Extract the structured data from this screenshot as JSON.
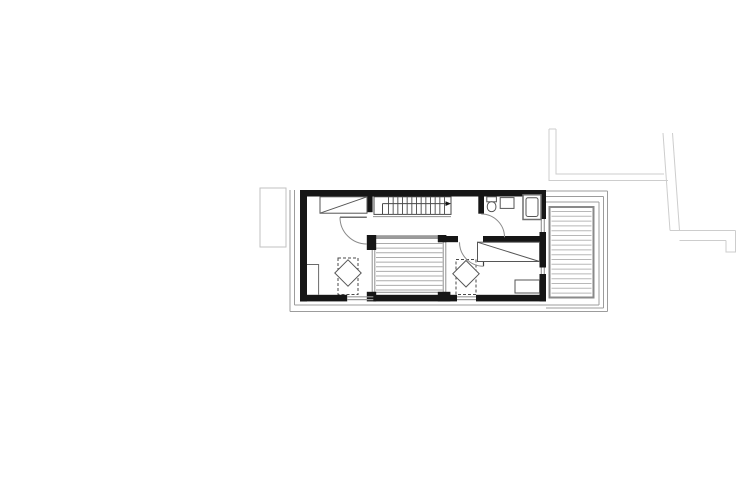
{
  "canvas": {
    "width": 737,
    "height": 492,
    "background": "#ffffff"
  },
  "palette": {
    "wall": "#161616",
    "fixture_line": "#565656",
    "stair_line": "#4a4a4a",
    "swing_arc": "#8a8a8a",
    "void_edge": "#8f8f8f",
    "deck_border": "#8a8a8a",
    "deck_hatch": "#b8b8b8",
    "void_hatch": "#ababab",
    "roof_outline": "#9c9c9c",
    "glazing": "#9a9a9a",
    "site_line": "#cdcdcd",
    "annex_line": "#c2c2c2",
    "beam": "#9b9b9b"
  },
  "drawing": {
    "elements": [
      {
        "type": "line",
        "name": "site-line-north-cap",
        "x1": 549,
        "y1": 129,
        "x2": 556,
        "y2": 129,
        "stroke": "#cdcdcd",
        "sw": 1
      },
      {
        "type": "polyline",
        "name": "site-line-west-outer",
        "points": "549,129 549,180.5 668,180.5",
        "stroke": "#cdcdcd",
        "sw": 1
      },
      {
        "type": "polyline",
        "name": "site-line-west-inner",
        "points": "556,129 556,174 664,174",
        "stroke": "#cdcdcd",
        "sw": 1
      },
      {
        "type": "line",
        "name": "site-line-east-outer-vertical",
        "x1": 663,
        "y1": 133,
        "x2": 670,
        "y2": 230.5,
        "stroke": "#cdcdcd",
        "sw": 1
      },
      {
        "type": "line",
        "name": "site-line-east-inner-vertical",
        "x1": 672.5,
        "y1": 133,
        "x2": 679.5,
        "y2": 230.5,
        "stroke": "#cdcdcd",
        "sw": 1
      },
      {
        "type": "line",
        "name": "site-line-east-top",
        "x1": 670,
        "y1": 230.5,
        "x2": 735.5,
        "y2": 230.5,
        "stroke": "#cdcdcd",
        "sw": 1
      },
      {
        "type": "line",
        "name": "site-line-east-bottom",
        "x1": 679.5,
        "y1": 240.5,
        "x2": 726,
        "y2": 240.5,
        "stroke": "#cdcdcd",
        "sw": 1
      },
      {
        "type": "polyline",
        "name": "site-line-east-cap",
        "points": "735.5,230.5 735.5,252 726,252 726,240.5",
        "stroke": "#cdcdcd",
        "sw": 1
      },
      {
        "type": "rect",
        "name": "left-annex-outline",
        "x": 260,
        "y": 188,
        "w": 26,
        "h": 59,
        "stroke": "#c2c2c2",
        "fill": "none",
        "sw": 1
      },
      {
        "type": "line",
        "name": "roof-outline-left-outer",
        "x1": 290,
        "y1": 190,
        "x2": 290,
        "y2": 311.5,
        "stroke": "#9c9c9c",
        "sw": 1
      },
      {
        "type": "line",
        "name": "roof-outline-left-inner",
        "x1": 294.5,
        "y1": 190,
        "x2": 294.5,
        "y2": 305,
        "stroke": "#9c9c9c",
        "sw": 1
      },
      {
        "type": "line",
        "name": "roof-outline-bottom-inner",
        "x1": 294.5,
        "y1": 305,
        "x2": 599,
        "y2": 305,
        "stroke": "#9c9c9c",
        "sw": 1
      },
      {
        "type": "line",
        "name": "roof-outline-bottom-outer",
        "x1": 290,
        "y1": 311.5,
        "x2": 607.5,
        "y2": 311.5,
        "stroke": "#9c9c9c",
        "sw": 1
      },
      {
        "type": "line",
        "name": "roof-outline-right-inner",
        "x1": 599,
        "y1": 202,
        "x2": 599,
        "y2": 305,
        "stroke": "#9c9c9c",
        "sw": 1
      },
      {
        "type": "line",
        "name": "roof-outline-right-mid",
        "x1": 603.5,
        "y1": 196.5,
        "x2": 603.5,
        "y2": 308,
        "stroke": "#9c9c9c",
        "sw": 1
      },
      {
        "type": "line",
        "name": "roof-outline-right-outer",
        "x1": 607.5,
        "y1": 191,
        "x2": 607.5,
        "y2": 311.5,
        "stroke": "#9c9c9c",
        "sw": 1
      },
      {
        "type": "line",
        "name": "roof-outline-top-right-outer",
        "x1": 546,
        "y1": 191,
        "x2": 607.5,
        "y2": 191,
        "stroke": "#9c9c9c",
        "sw": 1
      },
      {
        "type": "line",
        "name": "roof-outline-top-right-mid",
        "x1": 546,
        "y1": 196.5,
        "x2": 603.5,
        "y2": 196.5,
        "stroke": "#9c9c9c",
        "sw": 1
      },
      {
        "type": "line",
        "name": "roof-outline-top-right-inner",
        "x1": 546,
        "y1": 202,
        "x2": 599,
        "y2": 202,
        "stroke": "#9c9c9c",
        "sw": 1
      },
      {
        "type": "line",
        "name": "roof-outline-bottom-right-mid",
        "x1": 546,
        "y1": 308,
        "x2": 603.5,
        "y2": 308,
        "stroke": "#9c9c9c",
        "sw": 1
      },
      {
        "type": "rect",
        "name": "deck-border",
        "x": 549.5,
        "y": 207,
        "w": 44,
        "h": 90.5,
        "stroke": "#8a8a8a",
        "fill": "#ffffff",
        "sw": 2
      },
      {
        "type": "hatch",
        "name": "deck-decking-hatch",
        "x": 551.5,
        "y": 211.5,
        "w": 40,
        "h": 82,
        "step": 4.8,
        "dir": "h",
        "stroke": "#b8b8b8",
        "sw": 1
      },
      {
        "type": "rect",
        "name": "void-border",
        "x": 372.2,
        "y": 238.5,
        "w": 73.6,
        "h": 53.8,
        "stroke": "#8f8f8f",
        "fill": "#ffffff",
        "sw": 1
      },
      {
        "type": "line",
        "name": "void-left-inner-edge",
        "x1": 374.8,
        "y1": 238.5,
        "x2": 374.8,
        "y2": 292.3,
        "stroke": "#8f8f8f",
        "sw": 1
      },
      {
        "type": "line",
        "name": "void-right-inner-edge",
        "x1": 443.2,
        "y1": 238.5,
        "x2": 443.2,
        "y2": 292.3,
        "stroke": "#8f8f8f",
        "sw": 1
      },
      {
        "type": "hatch",
        "name": "void-hatch",
        "x": 376,
        "y": 243.5,
        "w": 66.5,
        "h": 46.5,
        "step": 4.65,
        "dir": "h",
        "stroke": "#ababab",
        "sw": 1
      },
      {
        "type": "rect",
        "name": "void-top-beam",
        "x": 372,
        "y": 235.2,
        "w": 74,
        "h": 3.6,
        "stroke": "none",
        "fill": "#9b9b9b"
      },
      {
        "type": "rect",
        "name": "stair-outline",
        "x": 374,
        "y": 196.8,
        "w": 77,
        "h": 17.6,
        "stroke": "#4a4a4a",
        "fill": "#ffffff",
        "sw": 1
      },
      {
        "type": "hatch",
        "name": "stair-treads",
        "x": 388.5,
        "y": 196.8,
        "w": 56,
        "h": 17.6,
        "step": 4.667,
        "dir": "v",
        "stroke": "#5a5a5a",
        "sw": 1
      },
      {
        "type": "line",
        "name": "stair-walkline",
        "x1": 382.5,
        "y1": 203.6,
        "x2": 446,
        "y2": 203.6,
        "stroke": "#4a4a4a",
        "sw": 1
      },
      {
        "type": "line",
        "name": "stair-walkline-start",
        "x1": 382.5,
        "y1": 203.6,
        "x2": 382.5,
        "y2": 214.4,
        "stroke": "#4a4a4a",
        "sw": 1
      },
      {
        "type": "polygon",
        "name": "stair-direction-arrow",
        "points": "445.5,201.2 451,203.6 445.5,206",
        "stroke": "none",
        "fill": "#161616"
      },
      {
        "type": "line",
        "name": "stair-opening-edge",
        "x1": 373,
        "y1": 216.6,
        "x2": 451,
        "y2": 216.6,
        "stroke": "#8f8f8f",
        "sw": 1
      },
      {
        "type": "rect",
        "name": "wall-top",
        "x": 300,
        "y": 190,
        "w": 246,
        "h": 6.5,
        "stroke": "none",
        "fill": "#161616"
      },
      {
        "type": "rect",
        "name": "wall-left",
        "x": 300,
        "y": 196.5,
        "w": 7,
        "h": 105,
        "stroke": "none",
        "fill": "#161616"
      },
      {
        "type": "rect",
        "name": "wall-bottom-seg-left",
        "x": 300,
        "y": 294.8,
        "w": 47.2,
        "h": 6.6,
        "stroke": "none",
        "fill": "#161616"
      },
      {
        "type": "rect",
        "name": "wall-bottom-seg-mid",
        "x": 373.3,
        "y": 294.8,
        "w": 83.7,
        "h": 6.6,
        "stroke": "none",
        "fill": "#161616"
      },
      {
        "type": "rect",
        "name": "wall-bottom-seg-right",
        "x": 476,
        "y": 294.8,
        "w": 70,
        "h": 6.6,
        "stroke": "none",
        "fill": "#161616"
      },
      {
        "type": "rect",
        "name": "wall-right-seg-top",
        "x": 539.5,
        "y": 196.5,
        "w": 6.5,
        "h": 22.5,
        "stroke": "none",
        "fill": "#161616"
      },
      {
        "type": "rect",
        "name": "wall-right-seg-mid",
        "x": 539.5,
        "y": 232,
        "w": 6.5,
        "h": 35.5,
        "stroke": "none",
        "fill": "#161616"
      },
      {
        "type": "rect",
        "name": "wall-right-seg-bottom",
        "x": 539.5,
        "y": 274,
        "w": 6.5,
        "h": 27.4,
        "stroke": "none",
        "fill": "#161616"
      },
      {
        "type": "rect",
        "name": "wall-room1-divider",
        "x": 366.8,
        "y": 196.5,
        "w": 5.8,
        "h": 15.7,
        "stroke": "none",
        "fill": "#161616"
      },
      {
        "type": "rect",
        "name": "wall-bath-divider",
        "x": 478.3,
        "y": 196.5,
        "w": 5.7,
        "h": 17.2,
        "stroke": "none",
        "fill": "#161616"
      },
      {
        "type": "rect",
        "name": "wall-bed2-seg-left",
        "x": 438,
        "y": 236,
        "w": 20,
        "h": 6.2,
        "stroke": "none",
        "fill": "#161616"
      },
      {
        "type": "rect",
        "name": "wall-bed2-seg-right",
        "x": 483,
        "y": 236,
        "w": 63,
        "h": 6.2,
        "stroke": "none",
        "fill": "#161616"
      },
      {
        "type": "rect",
        "name": "void-post-topleft",
        "x": 366.8,
        "y": 235,
        "w": 9.4,
        "h": 15,
        "stroke": "none",
        "fill": "#161616"
      },
      {
        "type": "rect",
        "name": "void-post-topright",
        "x": 437.8,
        "y": 235,
        "w": 8.6,
        "h": 7.2,
        "stroke": "none",
        "fill": "#161616"
      },
      {
        "type": "rect",
        "name": "void-post-bottomleft",
        "x": 366.8,
        "y": 291.8,
        "w": 9.4,
        "h": 9.6,
        "stroke": "none",
        "fill": "#161616"
      },
      {
        "type": "rect",
        "name": "void-post-bottomright",
        "x": 437.8,
        "y": 291.8,
        "w": 12.6,
        "h": 9.6,
        "stroke": "none",
        "fill": "#161616"
      },
      {
        "type": "line",
        "name": "window-bottom-left-pane1",
        "x1": 347.2,
        "y1": 296.8,
        "x2": 373.3,
        "y2": 296.8,
        "stroke": "#9a9a9a",
        "sw": 1.2
      },
      {
        "type": "line",
        "name": "window-bottom-left-pane2",
        "x1": 347.2,
        "y1": 299.6,
        "x2": 373.3,
        "y2": 299.6,
        "stroke": "#9a9a9a",
        "sw": 1.2
      },
      {
        "type": "line",
        "name": "window-bottom-right-pane1",
        "x1": 457,
        "y1": 296.8,
        "x2": 476,
        "y2": 296.8,
        "stroke": "#9a9a9a",
        "sw": 1.2
      },
      {
        "type": "line",
        "name": "window-bottom-right-pane2",
        "x1": 457,
        "y1": 299.6,
        "x2": 476,
        "y2": 299.6,
        "stroke": "#9a9a9a",
        "sw": 1.2
      },
      {
        "type": "line",
        "name": "window-east-upper-pane1",
        "x1": 541.3,
        "y1": 219,
        "x2": 541.3,
        "y2": 232,
        "stroke": "#9a9a9a",
        "sw": 1.2
      },
      {
        "type": "line",
        "name": "window-east-upper-pane2",
        "x1": 544.3,
        "y1": 219,
        "x2": 544.3,
        "y2": 232,
        "stroke": "#9a9a9a",
        "sw": 1.2
      },
      {
        "type": "line",
        "name": "window-east-lower-pane1",
        "x1": 541.3,
        "y1": 267.5,
        "x2": 541.3,
        "y2": 274,
        "stroke": "#9a9a9a",
        "sw": 1.2
      },
      {
        "type": "line",
        "name": "window-east-lower-pane2",
        "x1": 544.3,
        "y1": 267.5,
        "x2": 544.3,
        "y2": 274,
        "stroke": "#9a9a9a",
        "sw": 1.2
      },
      {
        "type": "rect",
        "name": "bed1-outline",
        "x": 320,
        "y": 196.8,
        "w": 47,
        "h": 16.4,
        "stroke": "#565656",
        "fill": "#ffffff",
        "sw": 1
      },
      {
        "type": "line",
        "name": "bed1-diagonal",
        "x1": 320,
        "y1": 213.2,
        "x2": 367,
        "y2": 196.8,
        "stroke": "#565656",
        "sw": 1
      },
      {
        "type": "polyline",
        "name": "bedroom1-closet-lines",
        "points": "307,264.5 318.6,264.5 318.6,294.8",
        "stroke": "#6a6a6a",
        "sw": 1
      },
      {
        "type": "rect",
        "name": "skylight-shaft-left",
        "x": 338,
        "y": 258,
        "w": 20,
        "h": 36.5,
        "stroke": "#4a4a4a",
        "fill": "none",
        "sw": 1,
        "dash": "3,2"
      },
      {
        "type": "polygon",
        "name": "skylight-diamond-left",
        "points": "348,259.8 361.2,273 348,286.2 334.8,273",
        "stroke": "#565656",
        "fill": "#ffffff",
        "sw": 1
      },
      {
        "type": "rect",
        "name": "skylight-shaft-right",
        "x": 456,
        "y": 259.5,
        "w": 20,
        "h": 35,
        "stroke": "#4a4a4a",
        "fill": "none",
        "sw": 1,
        "dash": "3,2"
      },
      {
        "type": "polygon",
        "name": "skylight-diamond-right",
        "points": "466,260.5 479.2,273.8 466,287 452.8,273.8",
        "stroke": "#565656",
        "fill": "#ffffff",
        "sw": 1
      },
      {
        "type": "line",
        "name": "door1-leaf",
        "x1": 340,
        "y1": 217.2,
        "x2": 366.8,
        "y2": 217.2,
        "stroke": "#3f3f3f",
        "sw": 1.2
      },
      {
        "type": "path",
        "name": "door1-swing-arc",
        "d": "M 340 217.2 A 26.8 26.8 0 0 0 366.8 244",
        "stroke": "#8a8a8a",
        "fill": "none",
        "sw": 1
      },
      {
        "type": "path",
        "name": "bathroom-door-swing-arc",
        "d": "M 481.2 214 A 23.3 23.3 0 0 1 504.5 237.3",
        "stroke": "#8a8a8a",
        "fill": "none",
        "sw": 1
      },
      {
        "type": "line",
        "name": "door2-leaf",
        "x1": 483.5,
        "y1": 242.2,
        "x2": 483.5,
        "y2": 266.2,
        "stroke": "#3f3f3f",
        "sw": 1.2
      },
      {
        "type": "path",
        "name": "door2-swing-arc",
        "d": "M 459.5 242.2 A 24 24 0 0 0 483.5 266.2",
        "stroke": "#8a8a8a",
        "fill": "none",
        "sw": 1
      },
      {
        "type": "rect",
        "name": "toilet-tank",
        "x": 486.8,
        "y": 196.8,
        "w": 9.6,
        "h": 5,
        "stroke": "#565656",
        "fill": "#ffffff",
        "sw": 1
      },
      {
        "type": "rect",
        "name": "toilet-bowl",
        "x": 487.3,
        "y": 201.8,
        "w": 8.6,
        "h": 9.8,
        "rx": 4.2,
        "stroke": "#565656",
        "fill": "#ffffff",
        "sw": 1
      },
      {
        "type": "rect",
        "name": "bathroom-sink",
        "x": 500.2,
        "y": 197.6,
        "w": 13.8,
        "h": 10.8,
        "stroke": "#565656",
        "fill": "#ffffff",
        "sw": 1
      },
      {
        "type": "rect",
        "name": "shower-tray",
        "x": 523,
        "y": 194.8,
        "w": 18,
        "h": 24.7,
        "stroke": "#6e6e6e",
        "fill": "#ffffff",
        "sw": 1.5
      },
      {
        "type": "rect",
        "name": "shower-inner",
        "x": 526,
        "y": 197.8,
        "w": 12,
        "h": 18.7,
        "rx": 2,
        "stroke": "#565656",
        "fill": "none",
        "sw": 1
      },
      {
        "type": "rect",
        "name": "bed2-outline",
        "x": 477.5,
        "y": 242.2,
        "w": 62,
        "h": 19.3,
        "stroke": "#565656",
        "fill": "#ffffff",
        "sw": 1
      },
      {
        "type": "line",
        "name": "bed2-diagonal",
        "x1": 477.5,
        "y1": 242.2,
        "x2": 539.5,
        "y2": 261.5,
        "stroke": "#565656",
        "sw": 1
      },
      {
        "type": "rect",
        "name": "bedroom2-nightstand",
        "x": 515,
        "y": 280,
        "w": 24.5,
        "h": 13,
        "stroke": "#565656",
        "fill": "#ffffff",
        "sw": 1
      }
    ]
  }
}
